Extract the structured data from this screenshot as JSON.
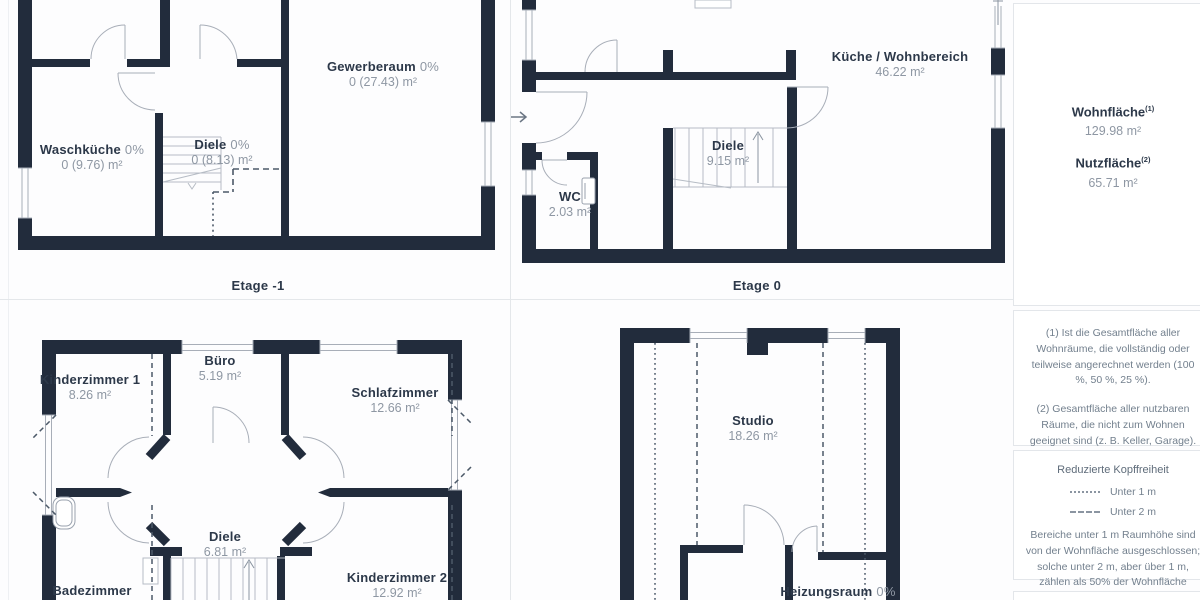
{
  "panels": [
    {
      "caption": "Etage -1",
      "rooms": [
        {
          "name": "Waschküche",
          "pct": "0%",
          "area": "0 (9.76) m²"
        },
        {
          "name": "Diele",
          "pct": "0%",
          "area": "0 (8.13) m²"
        },
        {
          "name": "Gewerberaum",
          "pct": "0%",
          "area": "0 (27.43) m²"
        }
      ]
    },
    {
      "caption": "Etage 0",
      "rooms": [
        {
          "name": "Küche / Wohnbereich",
          "area": "46.22 m²"
        },
        {
          "name": "Diele",
          "area": "9.15 m²"
        },
        {
          "name": "WC",
          "area": "2.03 m²"
        }
      ]
    },
    {
      "rooms": [
        {
          "name": "Kinderzimmer 1",
          "area": "8.26 m²"
        },
        {
          "name": "Büro",
          "area": "5.19 m²"
        },
        {
          "name": "Schlafzimmer",
          "area": "12.66 m²"
        },
        {
          "name": "Diele",
          "area": "6.81 m²"
        },
        {
          "name": "Badezimmer"
        },
        {
          "name": "Kinderzimmer 2",
          "area": "12.92 m²"
        }
      ]
    },
    {
      "rooms": [
        {
          "name": "Studio",
          "area": "18.26 m²"
        },
        {
          "name": "Heizungsraum",
          "pct": "0%"
        }
      ]
    }
  ],
  "sidebar": {
    "summary": {
      "wohnflaeche_label": "Wohnfläche",
      "wohnflaeche_sup": "(1)",
      "wohnflaeche_value": "129.98 m²",
      "nutzflaeche_label": "Nutzfläche",
      "nutzflaeche_sup": "(2)",
      "nutzflaeche_value": "65.71 m²"
    },
    "notes": {
      "note1": "(1) Ist die Gesamtfläche aller Wohnräume, die vollständig oder teilweise angerechnet werden (100 %, 50 %, 25 %).",
      "note2": "(2) Gesamtfläche aller nutzbaren Räume, die nicht zum Wohnen geeignet sind (z. B. Keller, Garage)."
    },
    "legend": {
      "title": "Reduzierte Kopffreiheit",
      "item1": "Unter 1 m",
      "item2": "Unter 2 m",
      "body": "Bereiche unter 1 m Raumhöhe sind von der Wohnfläche ausgeschlossen; solche unter 2 m, aber über 1 m, zählen als 50% der Wohnfläche"
    }
  },
  "colors": {
    "wall": "#222c3c",
    "thin_line": "#a8aeb8",
    "dash_line": "#4c5968",
    "room_name": "#2c3849",
    "room_area": "#8e97a3",
    "note_text": "#73808e"
  }
}
